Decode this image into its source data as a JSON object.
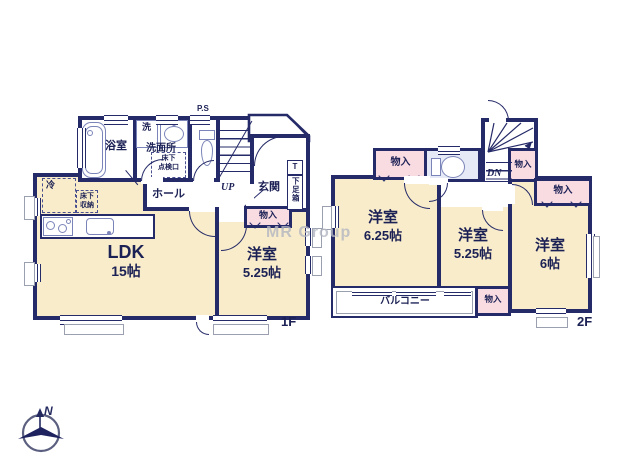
{
  "watermark": {
    "text": "MR Group"
  },
  "compass": {
    "north": "N"
  },
  "floor1": {
    "floor_label": "1F",
    "pipe_space": "P.S",
    "bathroom": {
      "label": "浴室"
    },
    "laundry": {
      "label": "洗"
    },
    "washroom": {
      "label": "洗面所"
    },
    "underfloor_hatch": {
      "line1": "床下",
      "line2": "点検口"
    },
    "hall": {
      "label": "ホール"
    },
    "stairs": {
      "label": "UP"
    },
    "entrance": {
      "label": "玄関",
      "shoe_box_top": "T",
      "shoe_box": "下足箱"
    },
    "kitchen": {
      "fridge": "冷",
      "underfloor_storage_line1": "床下",
      "underfloor_storage_line2": "収納"
    },
    "ldk": {
      "name": "LDK",
      "size": "15帖"
    },
    "closet": {
      "label": "物入"
    },
    "bedroom": {
      "name": "洋室",
      "size": "5.25帖"
    }
  },
  "floor2": {
    "floor_label": "2F",
    "stairs": {
      "label": "DN"
    },
    "closet_a": {
      "label": "物入"
    },
    "closet_b": {
      "label": "物入"
    },
    "closet_c": {
      "label": "物入"
    },
    "closet_d": {
      "label": "物入"
    },
    "bedroom1": {
      "name": "洋室",
      "size": "6.25帖"
    },
    "bedroom2": {
      "name": "洋室",
      "size": "5.25帖"
    },
    "bedroom3": {
      "name": "洋室",
      "size": "6帖"
    },
    "balcony": {
      "label": "バルコニー"
    }
  }
}
